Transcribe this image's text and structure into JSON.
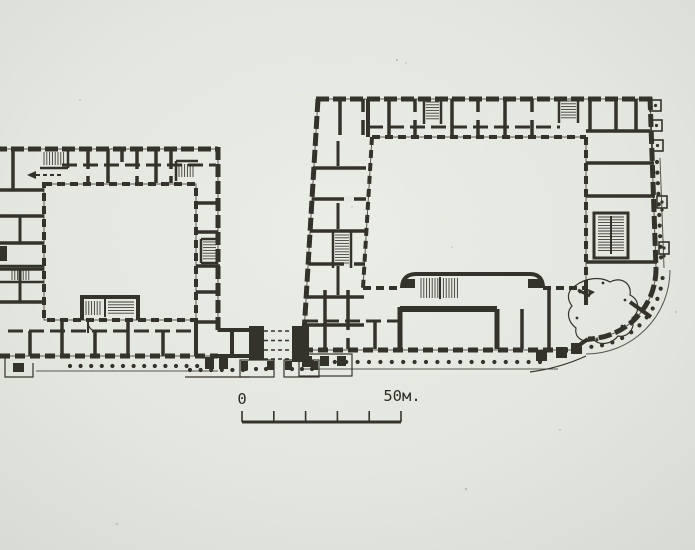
{
  "figure": {
    "kind": "scanned architectural floor-plan photograph",
    "subject": "Ground-floor plan of two courtyard blocks joined by a covered passage; the right block has a rounded colonnaded south-east corner",
    "script": "Cyrillic"
  },
  "scale_bar": {
    "zero_label": "0",
    "max_label": "50м.",
    "unit": "metres",
    "length_m": 50,
    "tick_count": 6
  },
  "palette": {
    "ink": "#34332b",
    "paper": "#e3e7e0",
    "paper_edge": "#d8dcd4"
  },
  "elements": {
    "left_building": "perimeter block with inner courtyard, cut off by left image edge; staircases hatched; south colonnade with porticoes",
    "right_building": "larger perimeter block with inner courtyard, double stair projecting into courtyard, rounded colonnaded corner with fan-shaped room",
    "link": "four dashed lines (covered bridge) between two solid piers with small column porticoes below"
  }
}
